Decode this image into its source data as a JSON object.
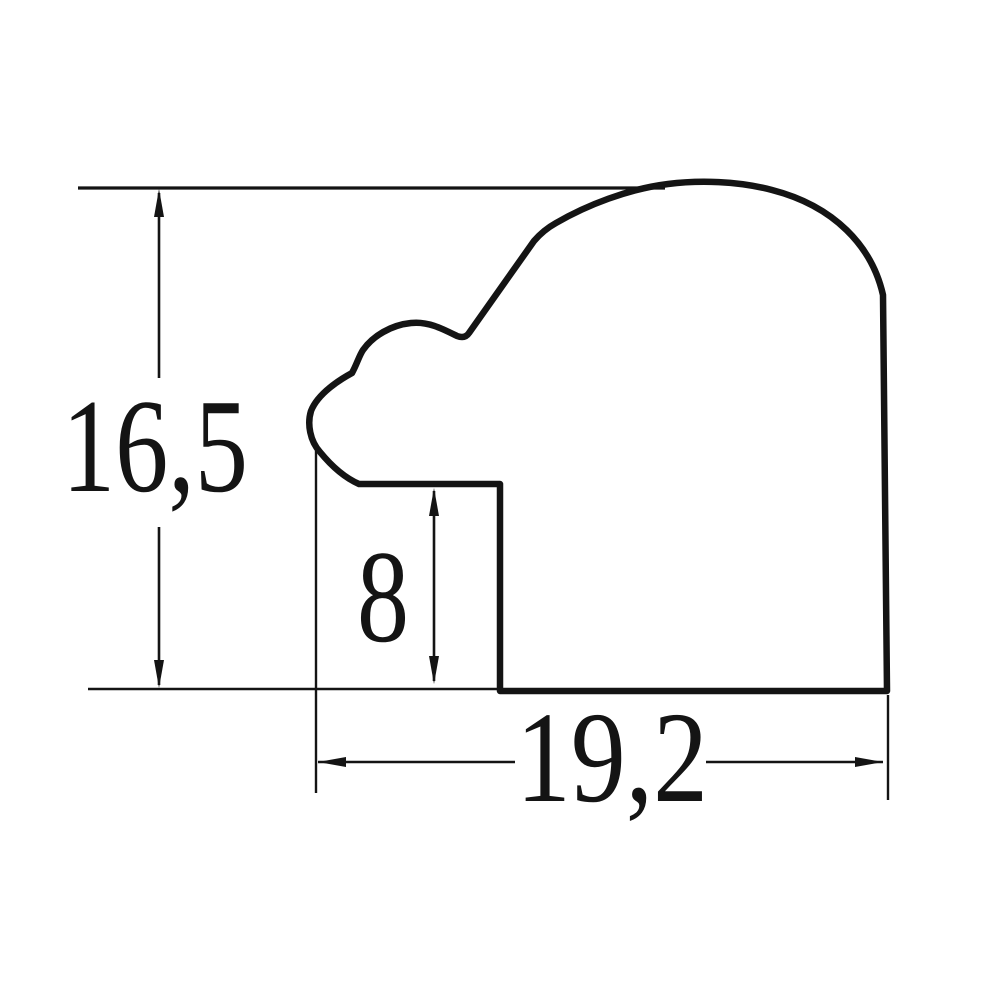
{
  "drawing": {
    "type": "technical-drawing",
    "subject": "picture-frame-moulding-profile-cross-section",
    "background_color": "#ffffff",
    "line_color": "#141414",
    "profile_path": "M 500,691 L 887,691 L 883,295 C 872,246 834,206 772,190 C 738,181 699,180 668,184 C 628,189 587,205 556,223 C 547,228 540,234 534,241 L 469,333 Q 465,339 457,336 C 443,329 428,321 411,323 C 391,325 373,336 363,350 C 359,356 357,364 352,373 C 341,379 318,393 311,411 C 307,424 310,441 320,452 C 329,463 343,477 359,484 L 500,484 Z",
    "dimensions": [
      {
        "id": "overall-height",
        "label": "16,5",
        "orientation": "vertical"
      },
      {
        "id": "rabbet-depth",
        "label": "8",
        "orientation": "vertical"
      },
      {
        "id": "overall-width",
        "label": "19,2",
        "orientation": "horizontal"
      }
    ]
  }
}
